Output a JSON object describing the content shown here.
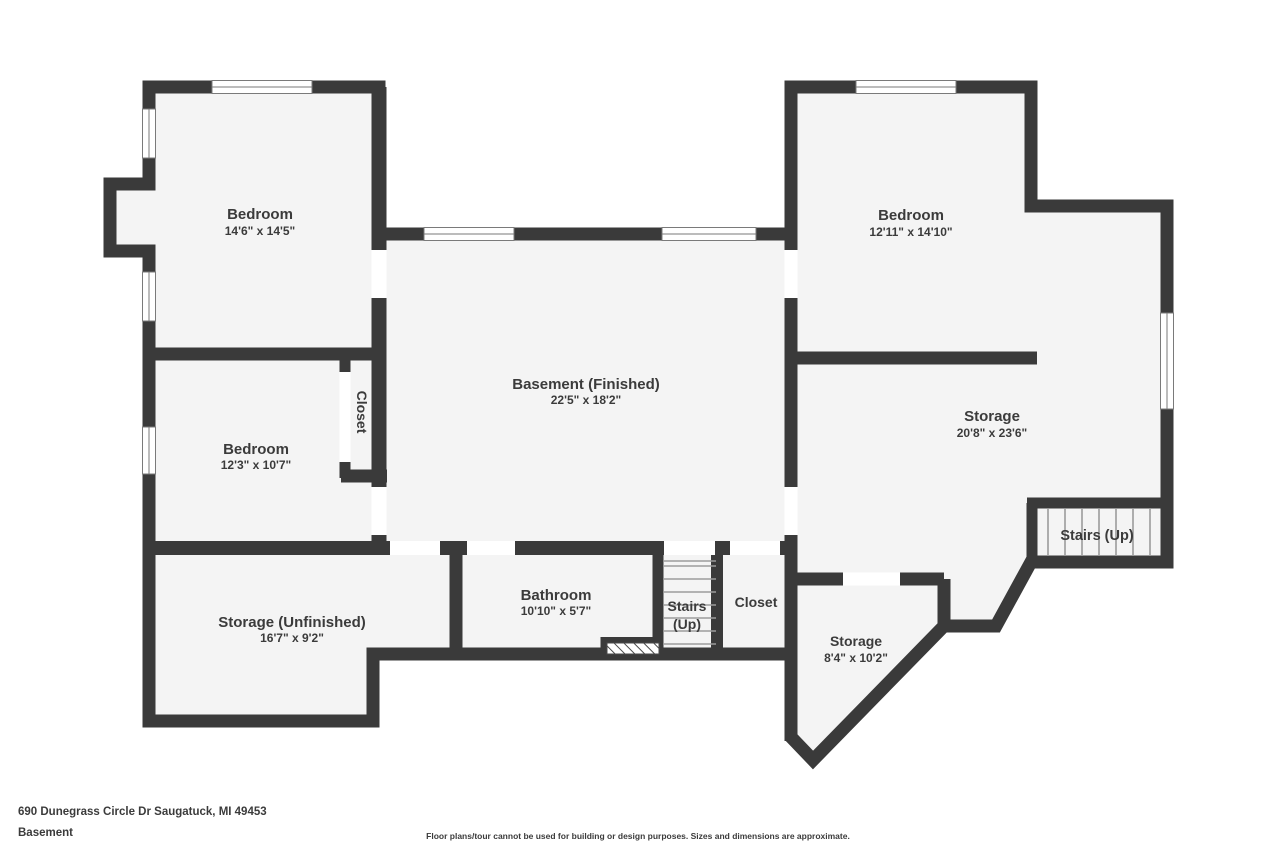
{
  "colors": {
    "wall": "#3a3a3a",
    "room_fill": "#f4f4f4",
    "label_text": "#3b3b3b",
    "window_frame": "#7a7a7a",
    "stair_tread": "#9b9b9b",
    "background": "#ffffff"
  },
  "rooms": [
    {
      "id": "bedroom-top-left",
      "name": "Bedroom",
      "dims": "14'6\" x 14'5\""
    },
    {
      "id": "bedroom-top-right",
      "name": "Bedroom",
      "dims": "12'11\" x 14'10\""
    },
    {
      "id": "basement-finished",
      "name": "Basement (Finished)",
      "dims": "22'5\" x 18'2\""
    },
    {
      "id": "bedroom-mid-left",
      "name": "Bedroom",
      "dims": "12'3\" x 10'7\""
    },
    {
      "id": "closet-mid",
      "name": "Closet"
    },
    {
      "id": "storage-right",
      "name": "Storage",
      "dims": "20'8\" x 23'6\""
    },
    {
      "id": "stairs-right",
      "name": "Stairs (Up)"
    },
    {
      "id": "storage-unfinished",
      "name": "Storage (Unfinished)",
      "dims": "16'7\" x 9'2\""
    },
    {
      "id": "bathroom",
      "name": "Bathroom",
      "dims": "10'10\" x 5'7\""
    },
    {
      "id": "stairs-center",
      "name": "Stairs",
      "name2": "(Up)"
    },
    {
      "id": "closet-bottom",
      "name": "Closet"
    },
    {
      "id": "storage-small",
      "name": "Storage",
      "dims": "8'4\" x 10'2\""
    }
  ],
  "footer": {
    "address": "690 Dunegrass Circle Dr Saugatuck, MI 49453",
    "level": "Basement",
    "disclaimer": "Floor plans/tour cannot be used for building or design purposes. Sizes and dimensions are approximate."
  }
}
